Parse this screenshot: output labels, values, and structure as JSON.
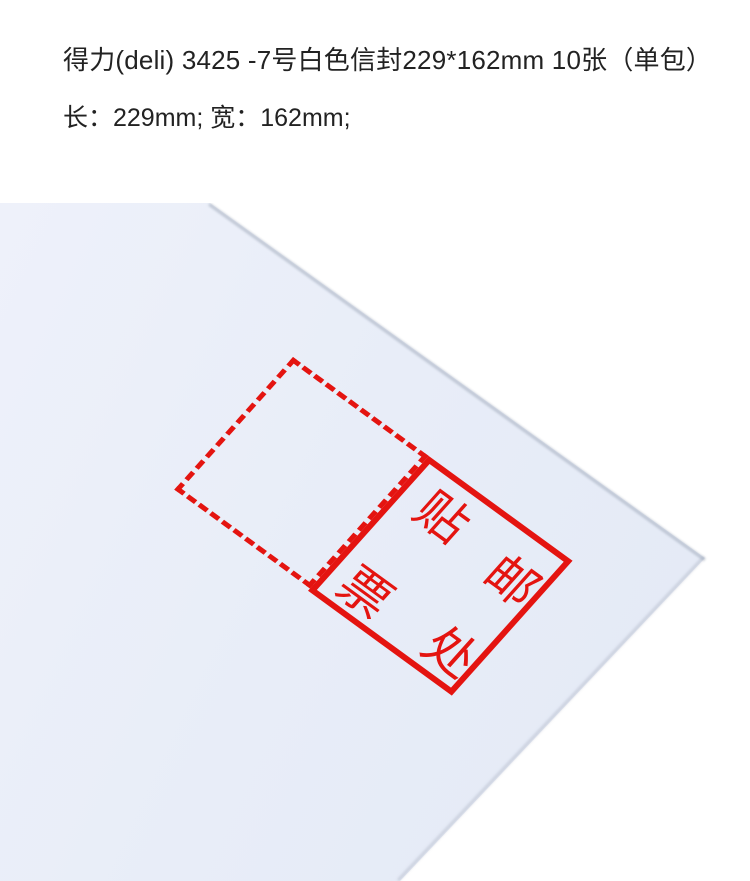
{
  "header": {
    "title": "得力(deli) 3425 -7号白色信封229*162mm 10张（单包）",
    "dimensions": "长：229mm; 宽：162mm;"
  },
  "photo": {
    "description_text_on_envelope": "贴邮票处",
    "stamp_chars": [
      "贴",
      "邮",
      "票",
      "处"
    ],
    "colors": {
      "stamp_red": "#e41410",
      "envelope_paper": "#e8edf8",
      "background": "#ffffff",
      "header_text": "#222222"
    }
  }
}
